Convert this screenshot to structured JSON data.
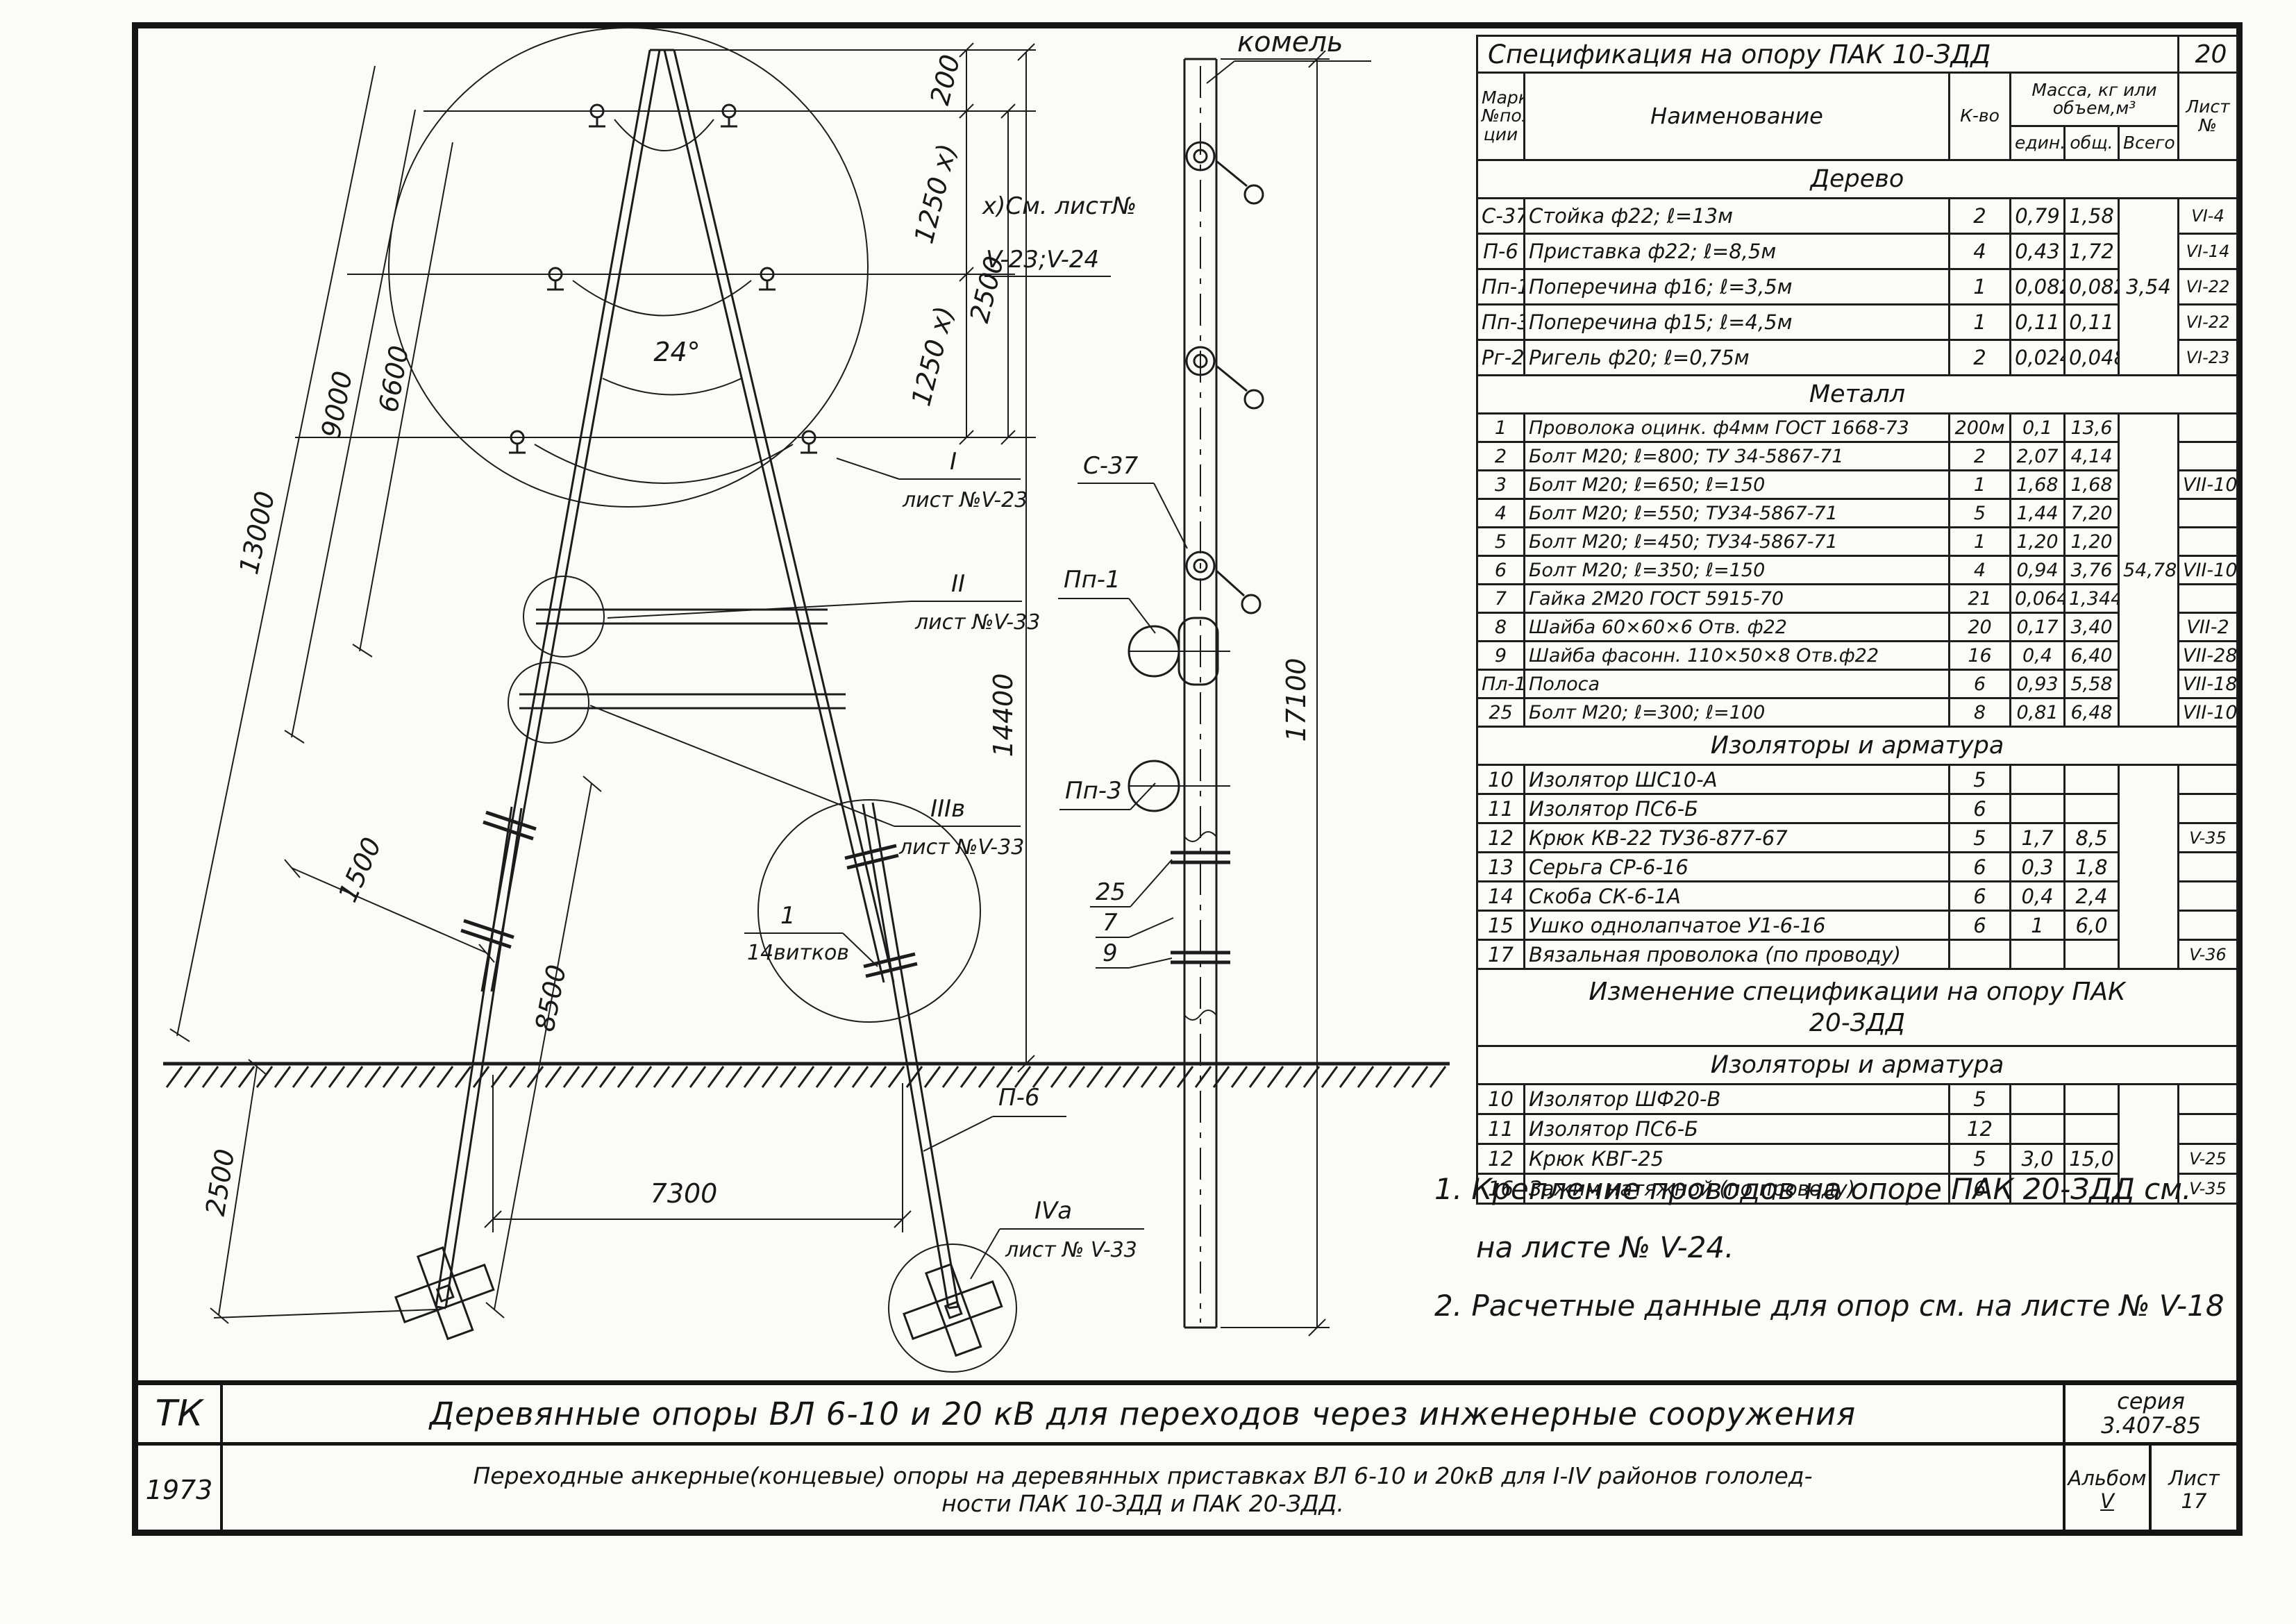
{
  "spec_table": {
    "title": "Спецификация на опору ПАК 10-ЗДД",
    "page_number": "20",
    "headers": {
      "mark": "Марка №пози- ции",
      "name": "Наименование",
      "qty": "К-во",
      "mass": "Масса, кг или объем,м³",
      "unit": "един.",
      "total": "общ.",
      "vsego": "Всего",
      "sheet": "Лист №"
    },
    "groups": [
      {
        "section": "Дерево",
        "vsego": "3,54",
        "row_class": "r-wood",
        "rows": [
          [
            "С-37",
            "Стойка ф22; ℓ=13м",
            "2",
            "0,79",
            "1,58",
            "VI-4"
          ],
          [
            "П-6",
            "Приставка ф22; ℓ=8,5м",
            "4",
            "0,43",
            "1,72",
            "VI-14"
          ],
          [
            "Пп-1",
            "Поперечина ф16; ℓ=3,5м",
            "1",
            "0,082",
            "0,082",
            "VI-22"
          ],
          [
            "Пп-3",
            "Поперечина ф15; ℓ=4,5м",
            "1",
            "0,11",
            "0,11",
            "VI-22"
          ],
          [
            "Рг-2",
            "Ригель ф20; ℓ=0,75м",
            "2",
            "0,024",
            "0,048",
            "VI-23"
          ]
        ]
      },
      {
        "section": "Металл",
        "vsego": "54,78",
        "row_class": "r-metal",
        "rows": [
          [
            "1",
            "Проволока оцинк. ф4мм ГОСТ 1668-73",
            "200м",
            "0,1",
            "13,6",
            ""
          ],
          [
            "2",
            "Болт М20; ℓ=800; ТУ 34-5867-71",
            "2",
            "2,07",
            "4,14",
            ""
          ],
          [
            "3",
            "Болт М20; ℓ=650; ℓ=150",
            "1",
            "1,68",
            "1,68",
            "VII-10"
          ],
          [
            "4",
            "Болт М20; ℓ=550; ТУ34-5867-71",
            "5",
            "1,44",
            "7,20",
            ""
          ],
          [
            "5",
            "Болт М20; ℓ=450; ТУ34-5867-71",
            "1",
            "1,20",
            "1,20",
            ""
          ],
          [
            "6",
            "Болт М20; ℓ=350; ℓ=150",
            "4",
            "0,94",
            "3,76",
            "VII-10"
          ],
          [
            "7",
            "Гайка 2М20 ГОСТ 5915-70",
            "21",
            "0,064",
            "1,344",
            ""
          ],
          [
            "8",
            "Шайба 60×60×6 Отв. ф22",
            "20",
            "0,17",
            "3,40",
            "VII-2"
          ],
          [
            "9",
            "Шайба фасонн. 110×50×8 Отв.ф22",
            "16",
            "0,4",
            "6,40",
            "VII-28"
          ],
          [
            "Пл-1",
            "Полоса",
            "6",
            "0,93",
            "5,58",
            "VII-18"
          ],
          [
            "25",
            "Болт М20; ℓ=300; ℓ=100",
            "8",
            "0,81",
            "6,48",
            "VII-10"
          ]
        ]
      },
      {
        "section": "Изоляторы и арматура",
        "vsego": "",
        "row_class": "r-izol",
        "rows": [
          [
            "10",
            "Изолятор ШС10-А",
            "5",
            "",
            "",
            ""
          ],
          [
            "11",
            "Изолятор ПС6-Б",
            "6",
            "",
            "",
            ""
          ],
          [
            "12",
            "Крюк КВ-22 ТУ36-877-67",
            "5",
            "1,7",
            "8,5",
            "V-35"
          ],
          [
            "13",
            "Серьга СР-6-16",
            "6",
            "0,3",
            "1,8",
            ""
          ],
          [
            "14",
            "Скоба СК-6-1А",
            "6",
            "0,4",
            "2,4",
            ""
          ],
          [
            "15",
            "Ушко однолапчатое У1-6-16",
            "6",
            "1",
            "6,0",
            ""
          ],
          [
            "17",
            "Вязальная проволока (по проводу)",
            "",
            "",
            "",
            "V-36"
          ]
        ]
      }
    ]
  },
  "change_table": {
    "title": "Изменение спецификации на опору ПАК 20-ЗДД",
    "groups": [
      {
        "section": "Изоляторы и арматура",
        "vsego": "",
        "row_class": "r-chg",
        "rows": [
          [
            "10",
            "Изолятор ШФ20-В",
            "5",
            "",
            "",
            ""
          ],
          [
            "11",
            "Изолятор ПС6-Б",
            "12",
            "",
            "",
            ""
          ],
          [
            "12",
            "Крюк КВГ-25",
            "5",
            "3,0",
            "15,0",
            "V-25"
          ],
          [
            "16",
            "Зажим натяжной (по проводу)",
            "6",
            "",
            "",
            "V-35"
          ]
        ]
      }
    ]
  },
  "notes": {
    "n1a": "1. Крепление проводов на опоре ПАК 20-ЗДД см.",
    "n1b": "на листе № V-24.",
    "n2": "2. Расчетные данные для опор см. на листе № V-18"
  },
  "title_block": {
    "code": "ТК",
    "year": "1973",
    "line1": "Деревянные опоры ВЛ 6-10 и 20 кВ для переходов через инженерные сооружения",
    "line2a": "Переходные анкерные(концевые) опоры на деревянных приставках ВЛ 6-10 и 20кВ для I-IV районов гололед-",
    "line2b": "ности ПАК 10-ЗДД и ПАК 20-ЗДД.",
    "series_label": "серия",
    "series_value": "3.407-85",
    "album_label": "Альбом",
    "album_value": "V",
    "sheet_label": "Лист",
    "sheet_value": "17"
  },
  "drawing": {
    "dim_13000": "13000",
    "dim_9000": "9000",
    "dim_6600": "6600",
    "dim_14400": "14400",
    "dim_17100": "17100",
    "dim_200": "200",
    "dim_1250_a": "1250 х)",
    "dim_1250_b": "1250 х)",
    "dim_2500_right": "2500",
    "dim_1500": "1500",
    "dim_8500": "8500",
    "dim_2500_left": "2500",
    "dim_7300": "7300",
    "angle": "24°",
    "footnote_line1": "х)См. лист№",
    "footnote_line2": "V-23;V-24",
    "callout_1_num": "I",
    "callout_1_sheet": "лист №V-23",
    "callout_2_num": "II",
    "callout_2_sheet": "лист №V-33",
    "callout_3_num": "IIIв",
    "callout_3_sheet": "лист №V-33",
    "callout_4_num": "IVа",
    "callout_4_sheet": "лист № V-33",
    "label_p6": "П-6",
    "label_c37": "С-37",
    "label_pp1": "Пп-1",
    "label_pp3": "Пп-3",
    "pos_1": "1",
    "pos_1_note": "14витков",
    "pos_25": "25",
    "pos_7": "7",
    "pos_9": "9",
    "label_komel": "комель"
  }
}
